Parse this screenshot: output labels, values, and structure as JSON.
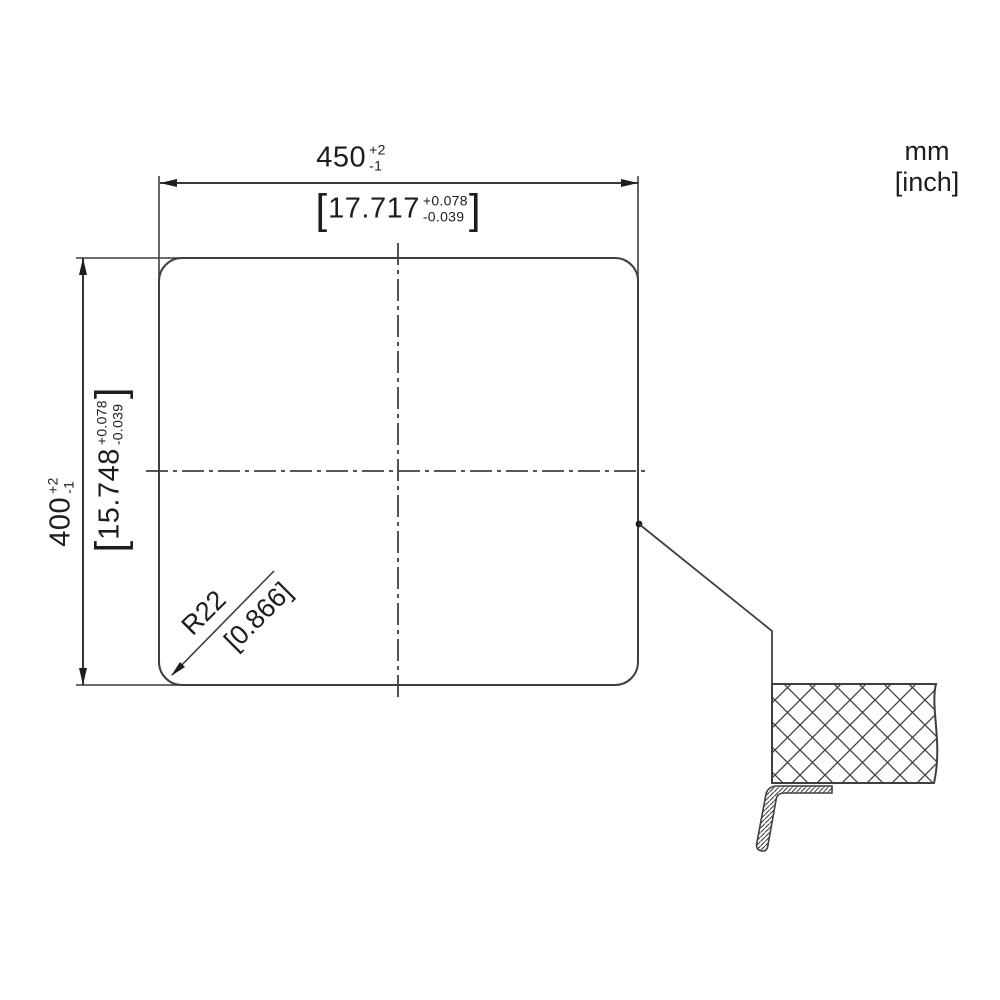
{
  "title": "sink cutout dimension drawing",
  "units": {
    "line1": "mm",
    "line2": "[inch]"
  },
  "dimensions": {
    "width": {
      "mm_value": "450",
      "mm_tol_plus": "+2",
      "mm_tol_minus": "-1",
      "bracket_open": "[",
      "inch_value": "17.717",
      "inch_tol_plus": "+0.078",
      "inch_tol_minus": "-0.039",
      "bracket_close": "]"
    },
    "height": {
      "mm_value": "400",
      "mm_tol_plus": "+2",
      "mm_tol_minus": "-1",
      "bracket_open": "[",
      "inch_value": "15.748",
      "inch_tol_plus": "+0.078",
      "inch_tol_minus": "-0.039",
      "bracket_close": "]"
    },
    "corner_radius": {
      "mm_label": "R22",
      "inch_label": "[0.866]"
    }
  },
  "colors": {
    "line": "#3f3f3f",
    "text": "#1d1d1d",
    "background": "#ffffff"
  }
}
